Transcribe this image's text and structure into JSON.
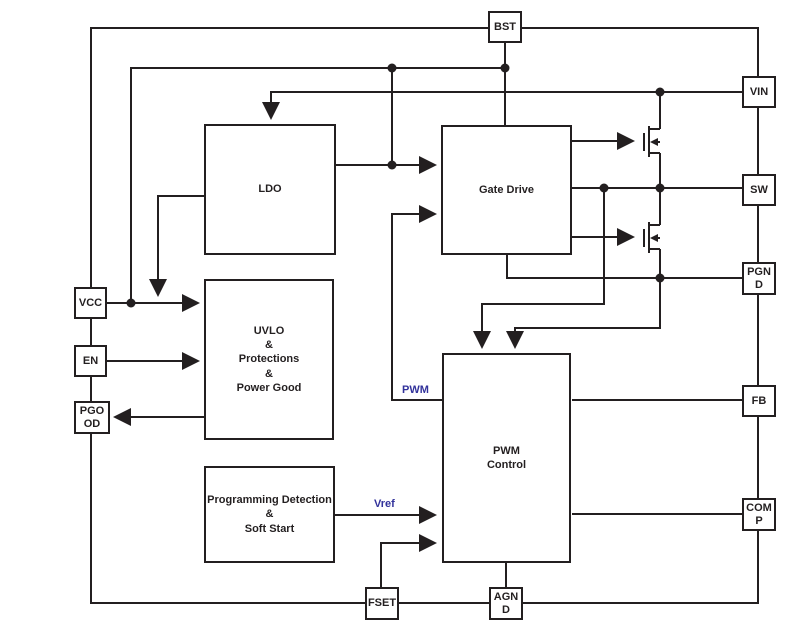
{
  "colors": {
    "background": "#ffffff",
    "wire": "#231f20",
    "text": "#231f20",
    "signal_label": "#32329b"
  },
  "blocks": {
    "ldo": {
      "label": "LDO"
    },
    "gate_drive": {
      "label": "Gate Drive"
    },
    "uvlo": {
      "label": "UVLO\n&\nProtections\n&\nPower Good"
    },
    "pwm_control": {
      "label": "PWM\nControl"
    },
    "programming": {
      "label": "Programming Detection\n&\nSoft Start"
    }
  },
  "pins": {
    "bst": {
      "label": "BST"
    },
    "vin": {
      "label": "VIN"
    },
    "sw": {
      "label": "SW"
    },
    "pgnd": {
      "label": "PGN\nD"
    },
    "fb": {
      "label": "FB"
    },
    "comp": {
      "label": "COM\nP"
    },
    "vcc": {
      "label": "VCC"
    },
    "en": {
      "label": "EN"
    },
    "pgood": {
      "label": "PGO\nOD"
    },
    "fset": {
      "label": "FSET"
    },
    "agnd": {
      "label": "AGN\nD"
    }
  },
  "signal_labels": {
    "pwm": "PWM",
    "vref": "Vref"
  }
}
